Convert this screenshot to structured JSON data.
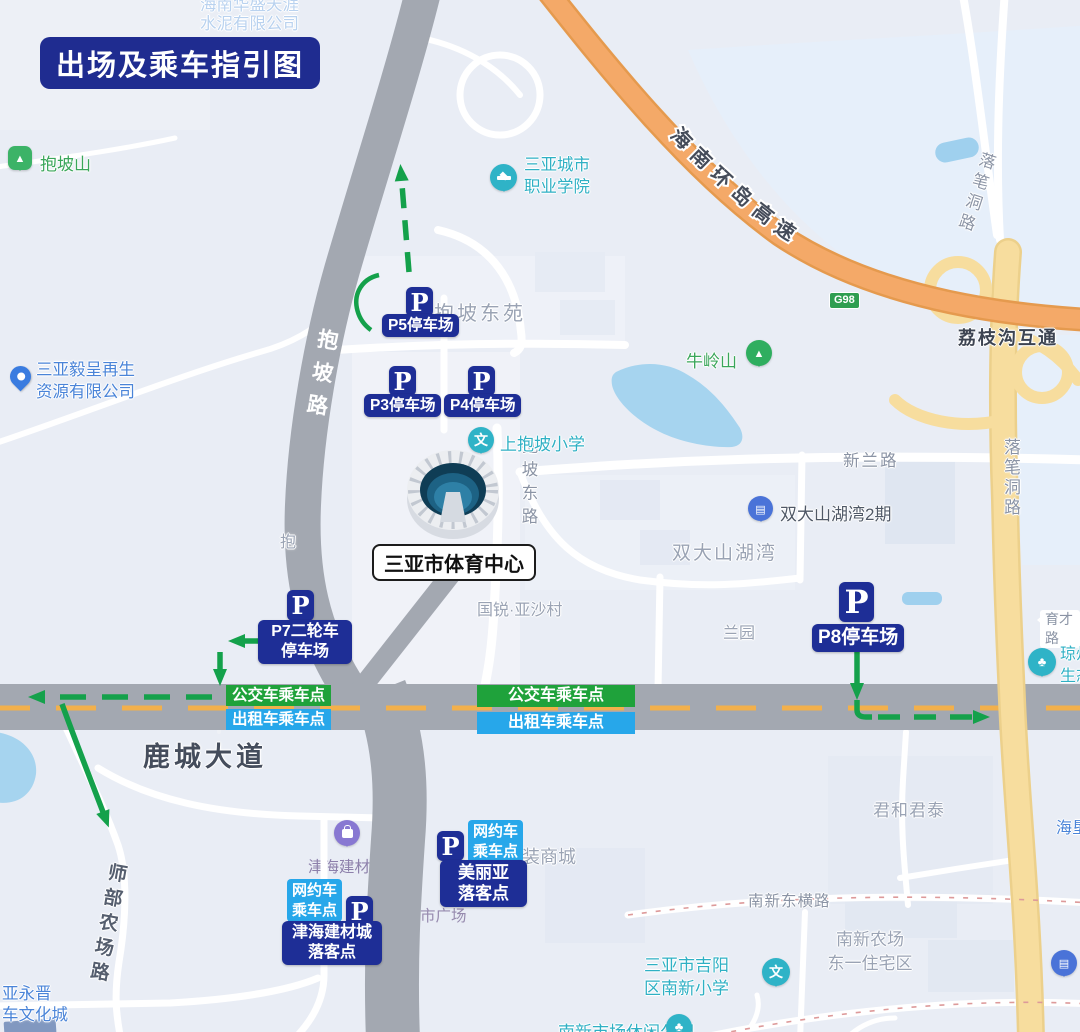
{
  "title": "出场及乘车指引图",
  "colors": {
    "badge_navy": "#1e2e96",
    "banner_green": "#1fa23b",
    "banner_blue": "#27a7ea",
    "arrow_green": "#14a14b",
    "road_gray": "#a3a8b1",
    "highway_orange": "#f4a968",
    "road_yellow": "#f7dd9e",
    "water_blue": "#a6d4ef",
    "map_bg": "#e9edf5"
  },
  "stadium": {
    "name": "三亚市体育中心"
  },
  "parking": {
    "p_letter": "P",
    "p5": "P5停车场",
    "p3": "P3停车场",
    "p4": "P4停车场",
    "p7_line1": "P7二轮车",
    "p7_line2": "停车场",
    "p8": "P8停车场"
  },
  "boarding": {
    "bus": "公交车乘车点",
    "taxi": "出租车乘车点",
    "rideshare_line1": "网约车",
    "rideshare_line2": "乘车点",
    "meilia_line1": "美丽亚",
    "meilia_line2": "落客点",
    "jinhai_line1": "津海建材城",
    "jinhai_line2": "落客点"
  },
  "roads": {
    "baopo": "抱坡路",
    "baopo_partial": "抱",
    "baopo_east": "抱坡东路",
    "lucheng": "鹿城大道",
    "xinlan": "新兰路",
    "nanxin_east": "南新东横路",
    "shibu": "师部农场路",
    "yucai": "育才路",
    "luobidong": "落笔洞路",
    "huandao": "海南环岛高速",
    "g98": "G98",
    "lizhigou": "荔枝沟互通"
  },
  "pois": {
    "baoposhan": "抱坡山",
    "vocational_line1": "三亚城市",
    "vocational_line2": "职业学院",
    "cement_line1": "海南华盛天涯",
    "cement_line2": "水泥有限公司",
    "recycle_line1": "三亚毅呈再生",
    "recycle_line2": "资源有限公司",
    "baopo_east_yuan": "抱坡东苑",
    "niulingshan": "牛岭山",
    "shangbaopo_primary": "上抱坡小学",
    "shuangda_phase2": "双大山湖湾2期",
    "shuangda": "双大山湖湾",
    "guorui": "国锐·亚沙村",
    "lanyuan": "兰园",
    "junhe": "君和君泰",
    "haiken": "海垦",
    "qiong_line1": "琼州",
    "qiong_line2": "生态",
    "jinhai_market": "津海建材市",
    "jinhai_plaza": "津海建材市广场",
    "shangcheng": "装商城",
    "nanxin_school_line1": "三亚市吉阳",
    "nanxin_school_line2": "区南新小学",
    "nanxin_res_line1": "南新农场",
    "nanxin_res_line2": "东一住宅区",
    "nanxin_park": "南新市场休闲公园",
    "yongjin_line1": "亚永晋",
    "yongjin_line2": "车文化城"
  }
}
